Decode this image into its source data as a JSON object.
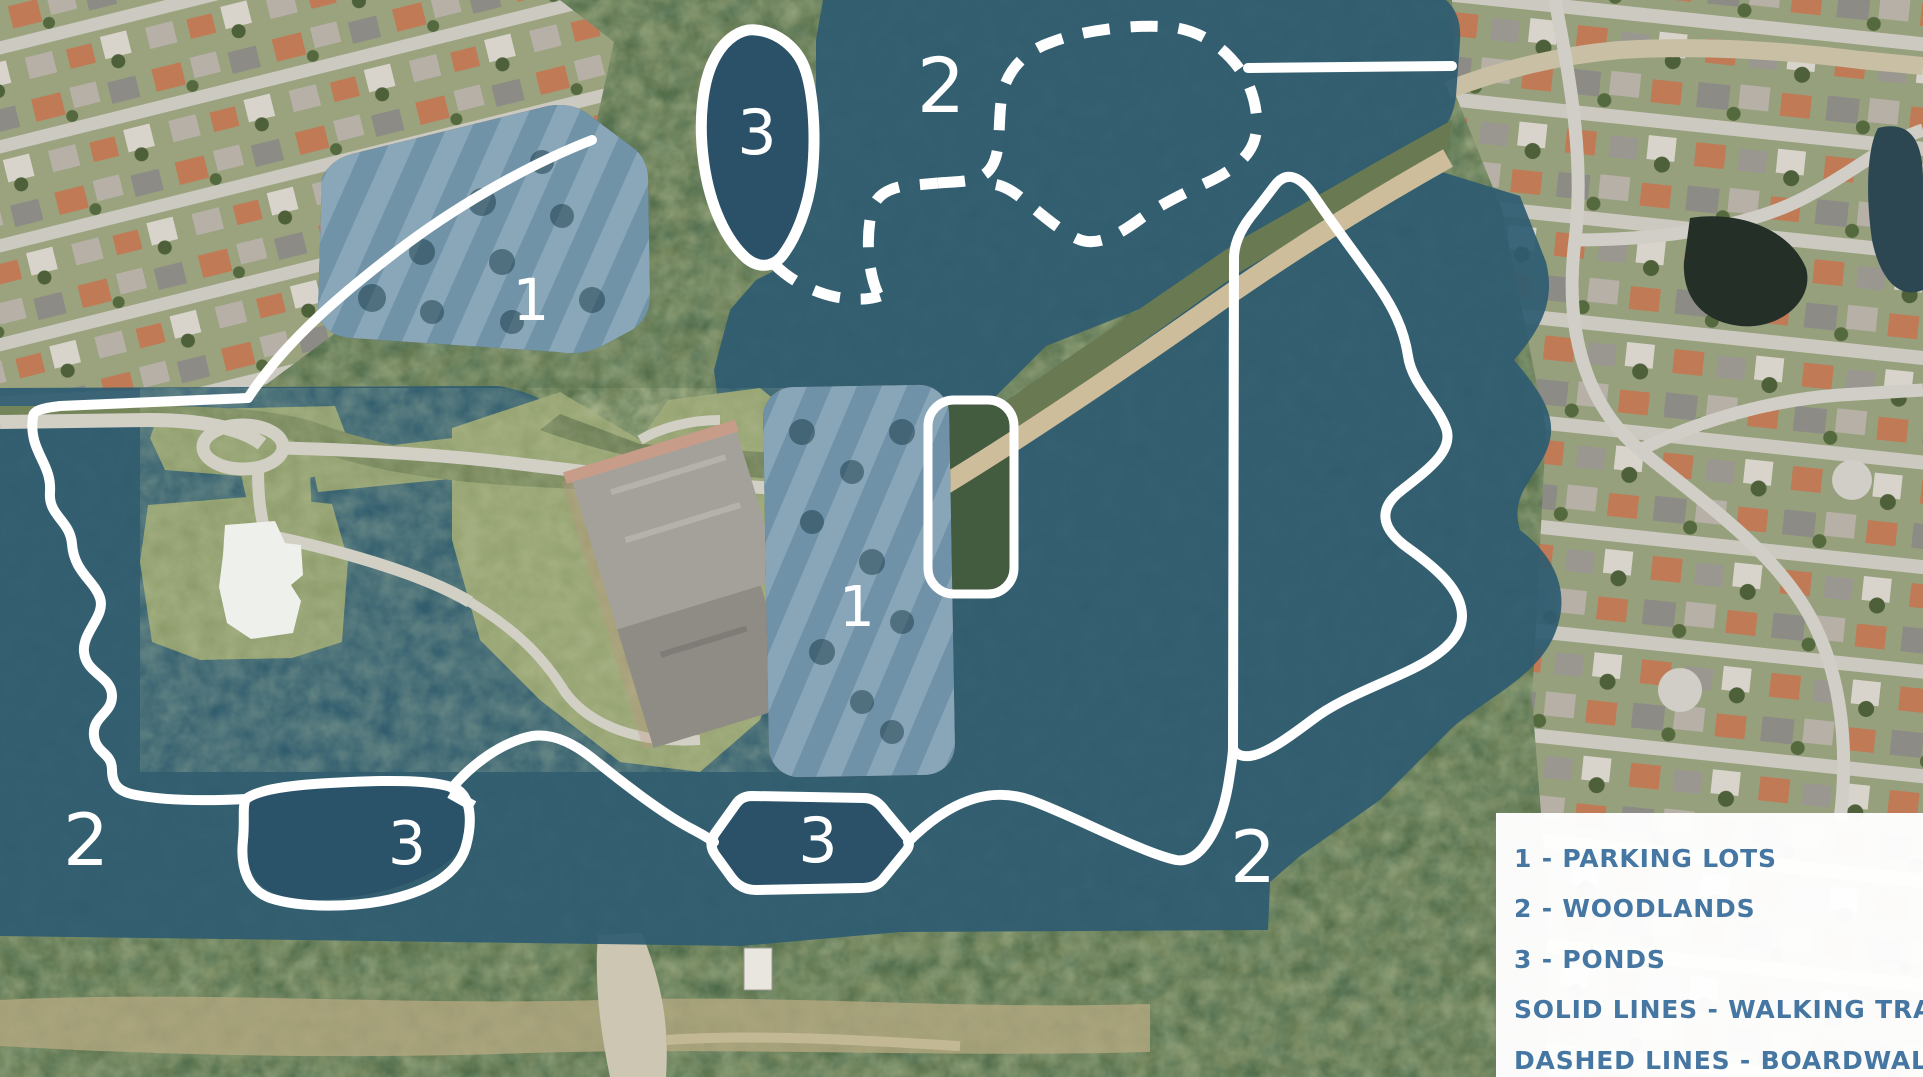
{
  "map": {
    "description_labels": [
      {
        "region": "parking-lot-north",
        "text": "1"
      },
      {
        "region": "woodland-north",
        "text": "2"
      },
      {
        "region": "pond-north",
        "text": "3"
      },
      {
        "region": "parking-lot-central",
        "text": "1"
      },
      {
        "region": "woodland-west",
        "text": "2"
      },
      {
        "region": "pond-southwest",
        "text": "3"
      },
      {
        "region": "pond-south",
        "text": "3"
      },
      {
        "region": "woodland-southeast",
        "text": "2"
      }
    ],
    "colors": {
      "woodland_overlay": "#2e5b71",
      "parking_overlay": "#5d89a8",
      "pond_fill": "#2a5168",
      "trail_line": "#ffffff",
      "legend_background": "#ffffff",
      "legend_text": "#4577a2"
    }
  },
  "legend": {
    "items": [
      "1 - PARKING LOTS",
      "2 - WOODLANDS",
      "3 - PONDS",
      "SOLID LINES - WALKING TRAIL",
      "DASHED LINES - BOARDWALK"
    ]
  }
}
